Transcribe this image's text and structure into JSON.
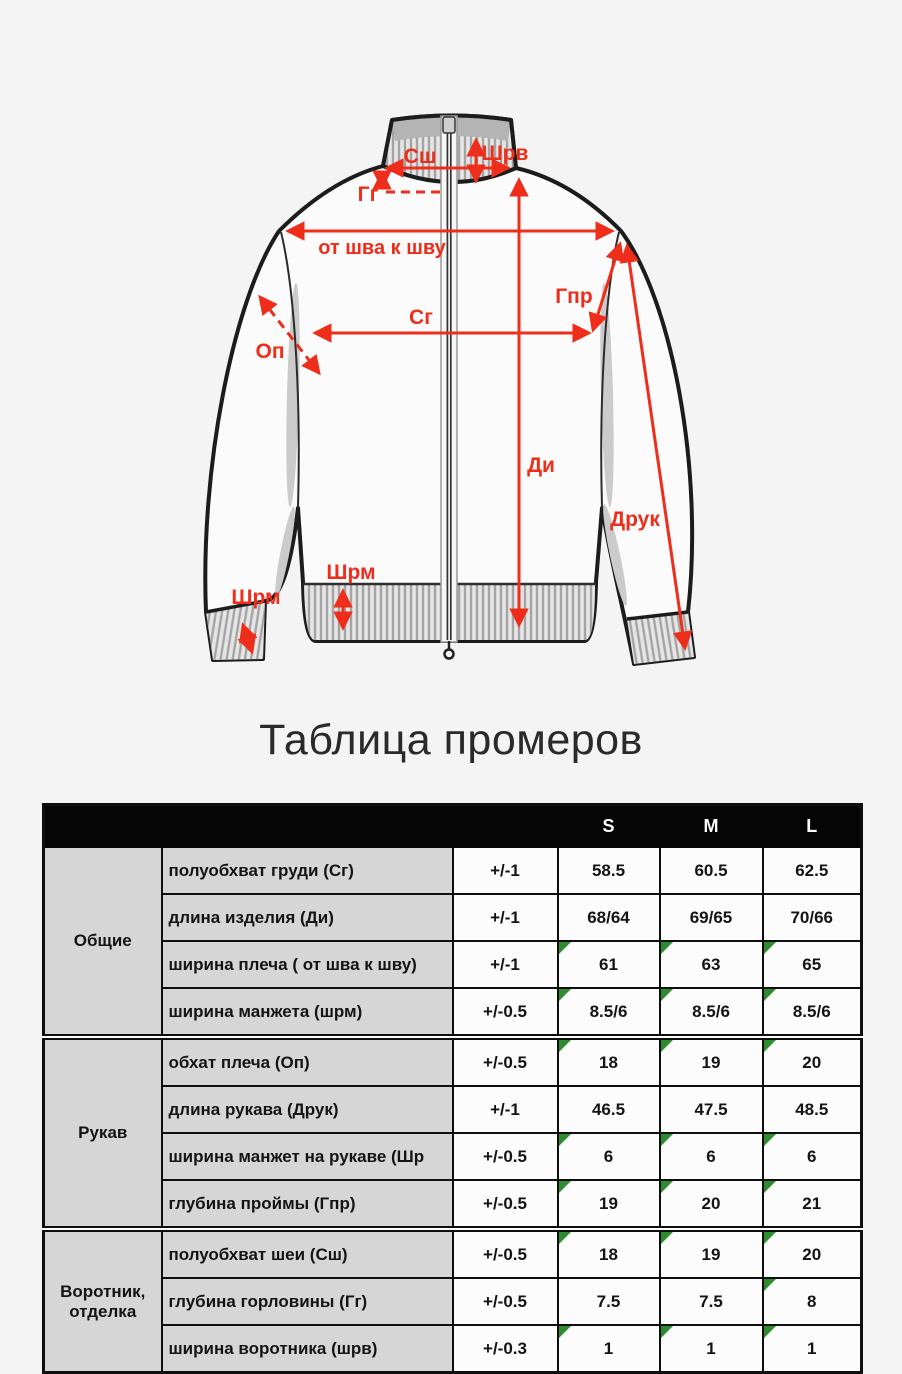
{
  "title": "Таблица промеров",
  "diagram": {
    "labels": {
      "neck_half": "Сш",
      "collar_width": "Шрв",
      "neck_depth": "Гг",
      "seam_to_seam": "от шва к шву",
      "chest_half": "Сг",
      "shoulder_girth": "Оп",
      "item_length": "Ди",
      "armhole_depth": "Гпр",
      "sleeve_length": "Друк",
      "hem_cuff_width": "Шрм",
      "sleeve_cuff_width": "Шрм"
    }
  },
  "table": {
    "size_headers": [
      "S",
      "M",
      "L"
    ],
    "groups": [
      {
        "name": "Общие",
        "rows": [
          {
            "label": "полуобхват груди (Сг)",
            "tolerance": "+/-1",
            "values": [
              "58.5",
              "60.5",
              "62.5"
            ],
            "markers": [
              false,
              false,
              false
            ]
          },
          {
            "label": "длина изделия (Ди)",
            "tolerance": "+/-1",
            "values": [
              "68/64",
              "69/65",
              "70/66"
            ],
            "markers": [
              false,
              false,
              false
            ]
          },
          {
            "label": "ширина плеча ( от шва к шву)",
            "tolerance": "+/-1",
            "values": [
              "61",
              "63",
              "65"
            ],
            "markers": [
              true,
              true,
              true
            ]
          },
          {
            "label": "ширина манжета (шрм)",
            "tolerance": "+/-0.5",
            "values": [
              "8.5/6",
              "8.5/6",
              "8.5/6"
            ],
            "markers": [
              true,
              true,
              true
            ]
          }
        ]
      },
      {
        "name": "Рукав",
        "rows": [
          {
            "label": "обхат плеча (Оп)",
            "tolerance": "+/-0.5",
            "values": [
              "18",
              "19",
              "20"
            ],
            "markers": [
              true,
              true,
              true
            ]
          },
          {
            "label": "длина рукава (Друк)",
            "tolerance": "+/-1",
            "values": [
              "46.5",
              "47.5",
              "48.5"
            ],
            "markers": [
              false,
              false,
              false
            ]
          },
          {
            "label": "ширина манжет на рукаве (Шр",
            "tolerance": "+/-0.5",
            "values": [
              "6",
              "6",
              "6"
            ],
            "markers": [
              true,
              true,
              true
            ]
          },
          {
            "label": "глубина проймы (Гпр)",
            "tolerance": "+/-0.5",
            "values": [
              "19",
              "20",
              "21"
            ],
            "markers": [
              true,
              true,
              true
            ]
          }
        ]
      },
      {
        "name": "Воротник, отделка",
        "rows": [
          {
            "label": "полуобхват шеи (Сш)",
            "tolerance": "+/-0.5",
            "values": [
              "18",
              "19",
              "20"
            ],
            "markers": [
              true,
              true,
              true
            ]
          },
          {
            "label": "глубина горловины (Гг)",
            "tolerance": "+/-0.5",
            "values": [
              "7.5",
              "7.5",
              "8"
            ],
            "markers": [
              false,
              false,
              true
            ]
          },
          {
            "label": "ширина воротника (шрв)",
            "tolerance": "+/-0.3",
            "values": [
              "1",
              "1",
              "1"
            ],
            "markers": [
              true,
              true,
              true
            ]
          }
        ]
      }
    ]
  },
  "colors": {
    "accent_red": "#ee2d1a",
    "marker_green": "#2e8b2e",
    "header_bg": "#050505",
    "label_bg": "#d6d6d6",
    "page_bg": "#f4f4f5"
  }
}
